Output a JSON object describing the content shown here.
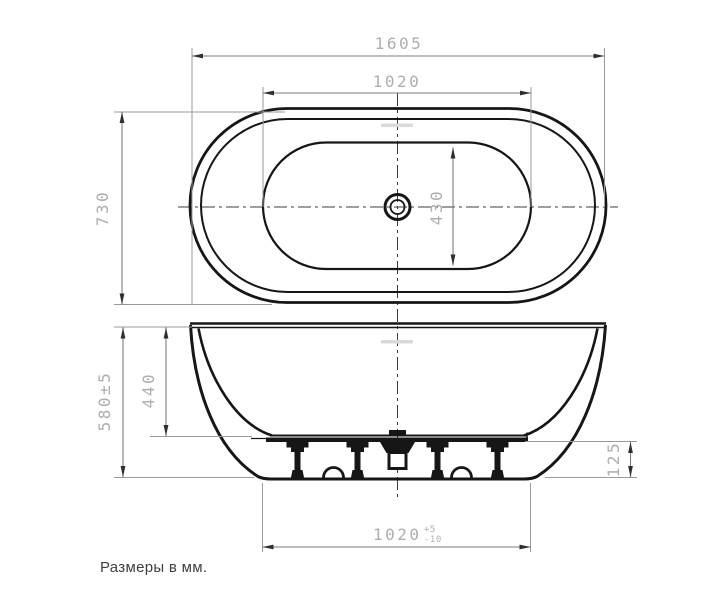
{
  "drawing": {
    "note": "Размеры в мм.",
    "top_view": {
      "dimensions": {
        "overall_length": "1605",
        "rim_length": "1020",
        "overall_width": "730",
        "basin_width": "430"
      }
    },
    "side_view": {
      "dimensions": {
        "overall_height": "580±5",
        "inner_depth": "440",
        "base_height": "125",
        "base_length": "1020",
        "base_length_tol_plus": "+5",
        "base_length_tol_minus": "-10"
      }
    },
    "colors": {
      "outline": "#161616",
      "dimension_text": "#aeaeae",
      "dimension_line": "#7d7d7d",
      "extension_line": "#9a9a9a",
      "centerline": "#3c3c3c",
      "note_text": "#3f3f3f",
      "overflow_mark": "#dadada",
      "background": "#ffffff"
    }
  }
}
